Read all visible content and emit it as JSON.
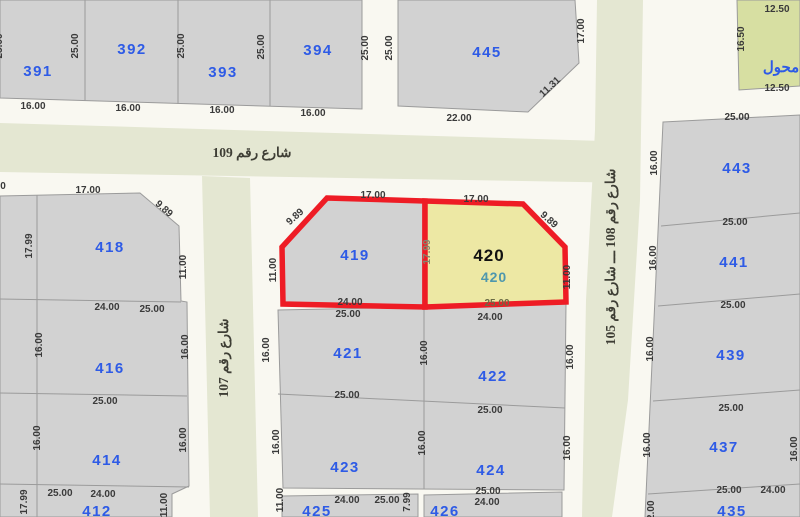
{
  "map_type": "cadastral-parcel-map",
  "colors": {
    "sidewalk": "#F9F8F1",
    "street_fill": "#E4E7D2",
    "parcel_fill": "#D2D2D2",
    "parcel_stroke": "#9B9B9B",
    "highlight_border": "#EE1C25",
    "highlight_fill": "#EDE8A4",
    "transformer_fill": "#D7DFA2",
    "number_blue": "#2E5BE6",
    "secondary_teal": "#4E97AD"
  },
  "streets": {
    "s109": "شارع رقم 109",
    "s107": "شارع رقم 107",
    "s108_105": "شارع رقم 108 ـــ شارع رقم 105"
  },
  "highlight": {
    "number": "420",
    "sub_number": "420"
  },
  "parcels": {
    "391": "391",
    "392": "392",
    "393": "393",
    "394": "394",
    "445": "445",
    "transformer": "محول",
    "418": "418",
    "416": "416",
    "414": "414",
    "412": "412",
    "419": "419",
    "421": "421",
    "423": "423",
    "425": "425",
    "426": "426",
    "422": "422",
    "424": "424",
    "443": "443",
    "441": "441",
    "439": "439",
    "437": "437",
    "435": "435"
  },
  "dims": {
    "block_391_394": {
      "left_partial": "25.00",
      "v": [
        "25.00",
        "25.00",
        "25.00"
      ],
      "bottom": [
        "16.00",
        "16.00",
        "16.00",
        "16.00"
      ]
    },
    "alley": [
      "25.00",
      "25.00"
    ],
    "p445": {
      "right": "17.00",
      "chamfer": "11.31",
      "bottom": "22.00"
    },
    "transformer": {
      "top": "12.50",
      "left": "16.50",
      "bottom": "12.50"
    },
    "street109_edge_partial": "0",
    "p418": {
      "top": "17.00",
      "chamfer": "9.89",
      "left": "17.99",
      "right": "11.00",
      "bottom": [
        "24.00",
        "25.00"
      ]
    },
    "p416": {
      "left": "16.00",
      "right": "16.00",
      "bottom": "25.00"
    },
    "p414": {
      "left": "16.00",
      "right": "16.00"
    },
    "p412": {
      "left": "17.99",
      "top": [
        "25.00",
        "24.00"
      ],
      "right": "11.00"
    },
    "p419": {
      "top": "17.00",
      "chamfer": "9.89",
      "left": "11.00",
      "right": "17.99",
      "bottom": [
        "24.00",
        "25.00"
      ]
    },
    "p420": {
      "top": "17.00",
      "chamfer": "9.89",
      "right": "11.00",
      "bottom": [
        "25.00",
        "24.00"
      ]
    },
    "p421": {
      "left": "16.00",
      "right": "16.00",
      "bottom": "25.00"
    },
    "p423": {
      "left": "16.00",
      "right": "16.00"
    },
    "row425": {
      "left": "11.00",
      "bottom": [
        "24.00",
        "25.00"
      ],
      "right": "7.99"
    },
    "p422": {
      "right": "16.00",
      "bottom": "25.00"
    },
    "p424": {
      "right": "16.00",
      "bottom": [
        "25.00",
        "24.00"
      ]
    },
    "p443": {
      "top": "25.00",
      "left": "16.00",
      "bottom": "25.00"
    },
    "p441": {
      "left": "16.00",
      "bottom": "25.00"
    },
    "p439": {
      "left": "16.00",
      "bottom": "25.00"
    },
    "p437": {
      "left": "16.00",
      "right": "16.00",
      "bottom": [
        "25.00",
        "24.00"
      ]
    },
    "p435": {
      "left": "12.00"
    }
  }
}
